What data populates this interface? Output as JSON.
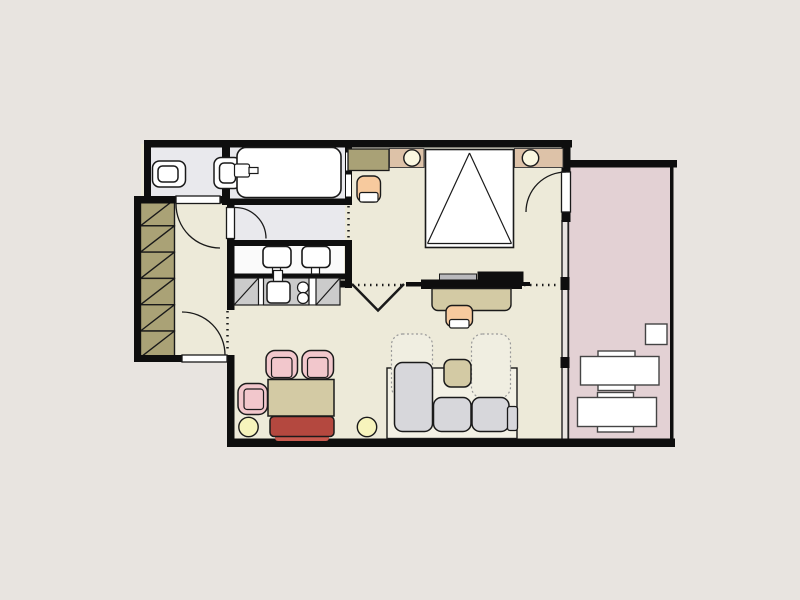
{
  "meta": {
    "type": "architectural-floor-plan",
    "rooms": [
      "wc",
      "bathroom",
      "entry-hall",
      "dressing-corridor",
      "kitchen",
      "living-dining-area",
      "bedroom-area",
      "balcony"
    ]
  },
  "canvas": {
    "width": 800,
    "height": 600,
    "background": "#e8e4e0"
  },
  "colors": {
    "background": "#e8e4e0",
    "wall": "#0e0e0e",
    "outline": "#1a1a1a",
    "floor_main": "#edead9",
    "floor_wet": "#e9e9ed",
    "vanity_counter": "#fafafa",
    "balcony_floor": "#e3d1d4",
    "wardrobe": "#aaa276",
    "counter_gray": "#cbcbcb",
    "sofa_gray": "#d7d7db",
    "sofa_base": "#f3f1e5",
    "sofa_bed_dotted": "#f0eee1",
    "furniture_tan": "#d3caa4",
    "headboard_tan": "#ddc2a8",
    "dresser_olive": "#a9a176",
    "peach": "#f7ca9e",
    "pink": "#f2c7cc",
    "red": "#b4483f",
    "red_light": "#c8594e",
    "lamp_yellow": "#f7f4bc",
    "lamp_pale": "#faf7e0",
    "white": "#ffffff",
    "dotted_gray": "#999999",
    "keyboard_gray": "#b9b9bc",
    "screen_gray": "#e6e6e6"
  },
  "furniture": {
    "wc": [
      "toilet",
      "wall-mounted-toilet"
    ],
    "bathroom": [
      "bathtub",
      "double-sink-vanity"
    ],
    "entry_hall": [
      "wardrobe-six-sections"
    ],
    "kitchen": [
      "corner-cabinet-left",
      "kitchen-sink",
      "cooktop-two-burners",
      "corner-cabinet-right"
    ],
    "bedroom_area": [
      "dresser",
      "armchair",
      "headboard-shelf-left",
      "headboard-shelf-right",
      "bedside-lamp-left",
      "bedside-lamp-right",
      "double-bed"
    ],
    "study_zone": [
      "tv-sideboard",
      "desk",
      "desk-chair"
    ],
    "living_dining": [
      "dining-chair-top-1",
      "dining-chair-top-2",
      "dining-chair-left",
      "dining-table",
      "red-bench",
      "floor-lamp-left",
      "floor-lamp-right",
      "corner-sofa",
      "sofa-bed-extension-left",
      "sofa-bed-extension-right",
      "side-table"
    ],
    "balcony": [
      "small-table",
      "lounge-table-upper",
      "lounge-table-lower"
    ]
  }
}
